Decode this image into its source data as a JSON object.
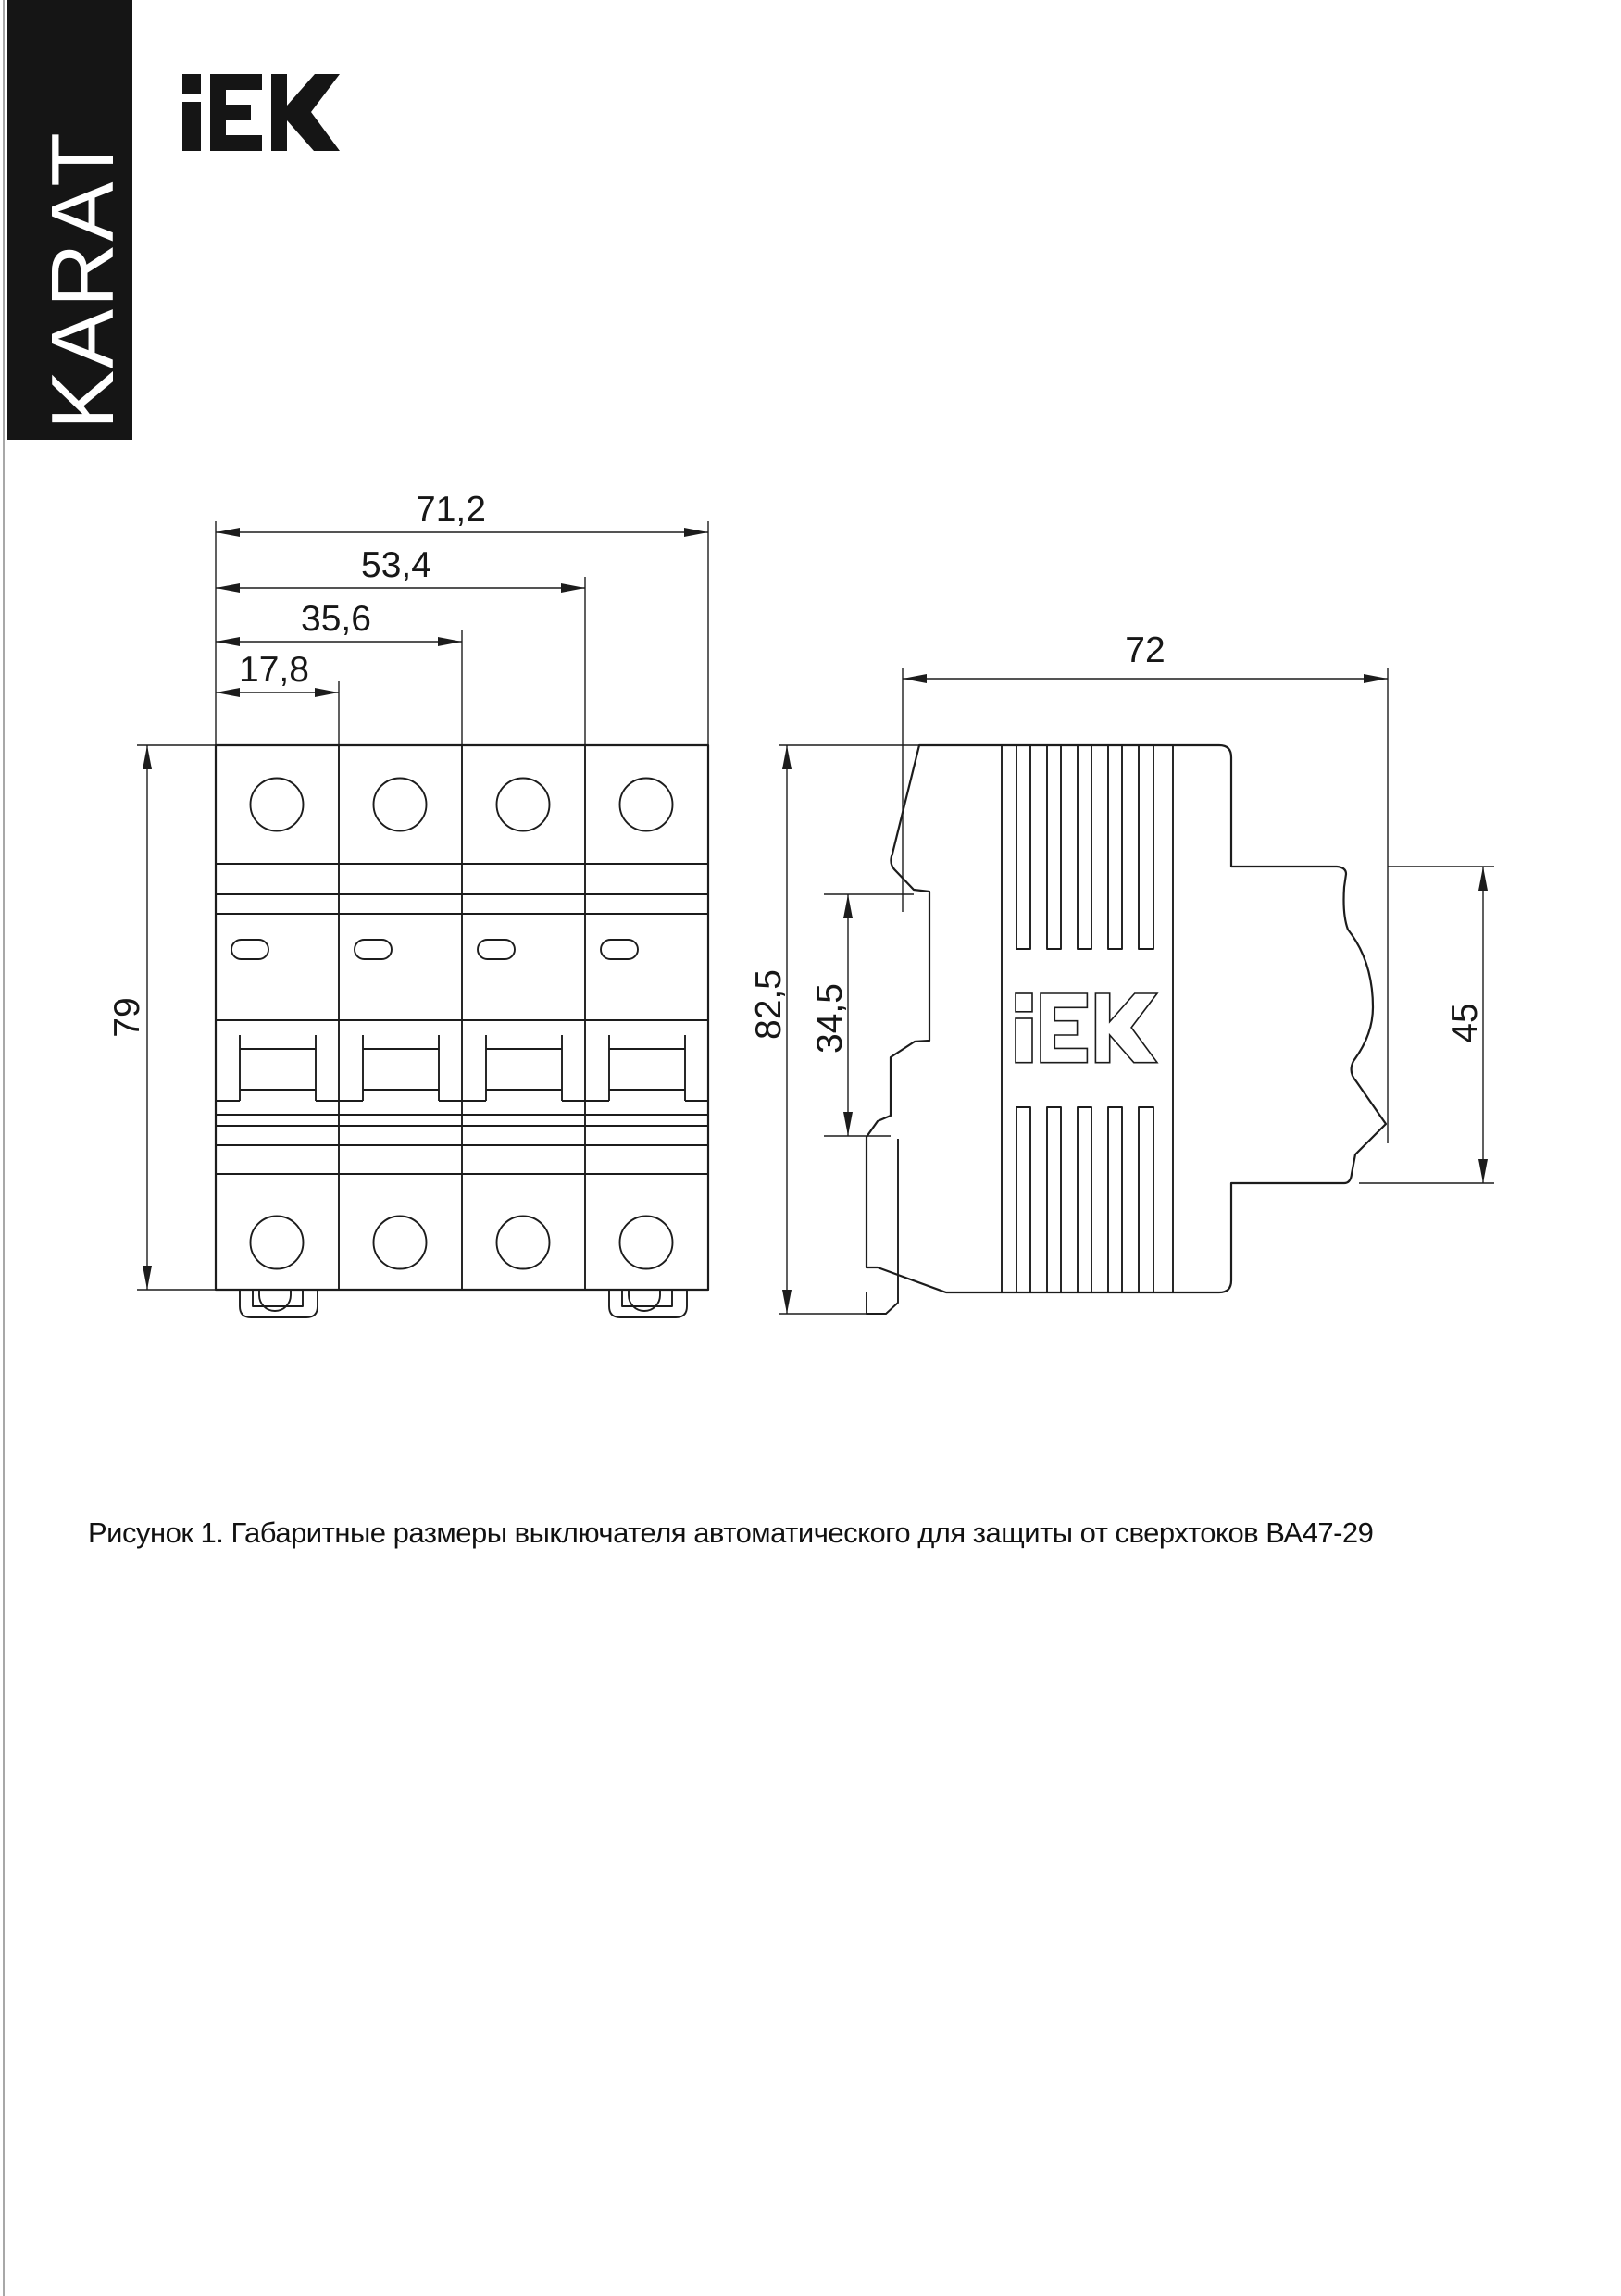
{
  "banner": {
    "text": "KARAT"
  },
  "brand": {
    "logo_name": "IEK"
  },
  "figure": {
    "front_view": {
      "name": "front view of 4-pole circuit breaker",
      "dims": {
        "width_total": "71,2",
        "width_three_modules": "53,4",
        "width_two_modules": "35,6",
        "width_one_module": "17,8",
        "height": "79"
      }
    },
    "side_view": {
      "name": "side view of circuit breaker",
      "dims": {
        "depth_total": "72",
        "height_total": "82,5",
        "din_recess_height": "34,5",
        "front_face_height": "45"
      }
    }
  },
  "caption": {
    "text": "Рисунок 1. Габаритные размеры выключателя автоматического для защиты от сверхтоков ВА47-29"
  }
}
